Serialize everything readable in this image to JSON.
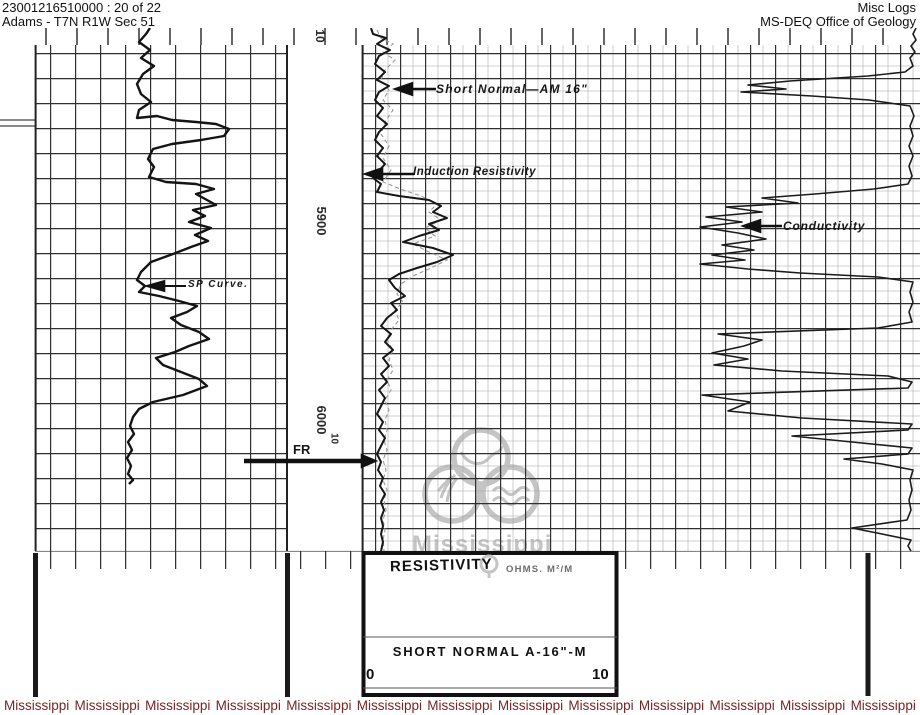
{
  "header": {
    "doc_id_line": "23001216510000 : 20 of 22",
    "location_line": "Adams - T7N R1W Sec 51",
    "app_title": "Misc Logs",
    "org_name": "MS-DEQ Office of Geology"
  },
  "log": {
    "depth_scale": {
      "top_label": "10",
      "label_upper": "5900",
      "label_lower": "6000"
    },
    "annotations": {
      "short_normal": "Short Normal—AM 16\"",
      "induction_resistivity": "Induction Resistivity",
      "conductivity": "Conductivity",
      "sp_curve": "SP Curve.",
      "fr_marker": "FR",
      "fr_scale": "10"
    },
    "legend": {
      "title": "RESISTIVITY",
      "units": "OHMS. M²/M",
      "curve_name": "SHORT NORMAL A-16\"-M",
      "scale_min": "0",
      "scale_max": "10"
    },
    "watermark_logo_text": "Mississippi"
  },
  "footer": {
    "words": [
      "Mississippi",
      "Mississippi",
      "Mississippi",
      "Mississippi",
      "Mississippi",
      "Mississippi",
      "Mississippi",
      "Mississippi",
      "Mississippi",
      "Mississippi",
      "Mississippi",
      "Mississippi",
      "Mississippi"
    ]
  },
  "colors": {
    "footer_watermark": "#7a2424",
    "logo_watermark": "#c4c4c4",
    "scan_ink": "#1c1c1c"
  }
}
